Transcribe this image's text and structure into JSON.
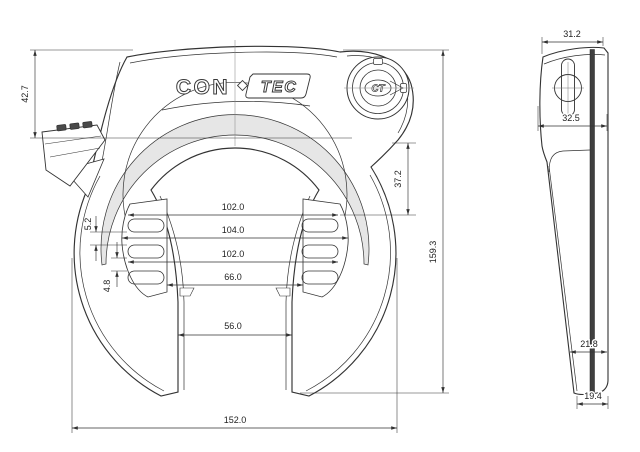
{
  "colors": {
    "line": "#333333",
    "dim_line": "#333333",
    "text": "#222222",
    "background": "#ffffff",
    "band_fill": "#e6e6e6",
    "dark_fill": "#3f3f3f"
  },
  "logo": {
    "part1": "CON",
    "part2": "TEC",
    "emblem": "CT"
  },
  "front_view": {
    "dims": {
      "d42_7": "42.7",
      "d37_2": "37.2",
      "d159_3": "159.3",
      "d102_top": "102.0",
      "d104": "104.0",
      "d102_mid": "102.0",
      "d66": "66.0",
      "d56": "56.0",
      "d152": "152.0",
      "d5_2": "5.2",
      "d4_8": "4.8"
    }
  },
  "side_view": {
    "dims": {
      "d31_2": "31.2",
      "d32_5": "32.5",
      "d21_8": "21.8",
      "d19_4": "19.4"
    }
  }
}
